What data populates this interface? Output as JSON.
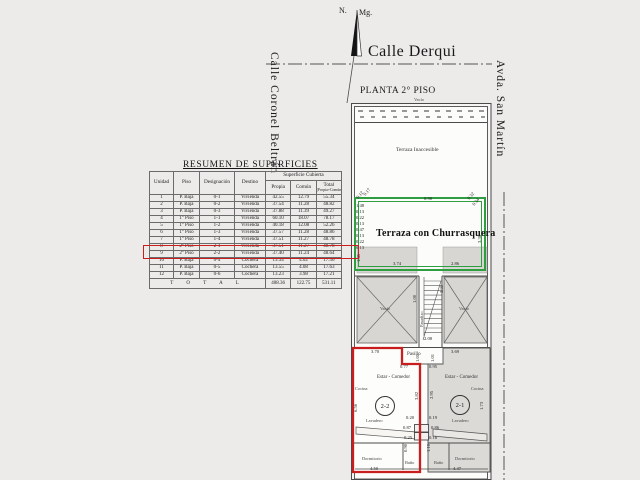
{
  "compass": {
    "north": "N.",
    "magnetic": "Mg."
  },
  "streets": {
    "top": "Calle Derqui",
    "left": "Calle Coronel Beltrán",
    "right": "Avda. San Martín"
  },
  "plan": {
    "title": "PLANTA 2° PISO",
    "band_label": "Vacío",
    "terraza_inaccesible": "Terraza Inaccesible",
    "terraza_churrasquera": "Terraza con Churrasquera",
    "vacio_left": "Vacío",
    "vacio_right": "Vacío",
    "pasadizo": "Pasadizo",
    "pasillo": "Pasillo",
    "units": {
      "left": {
        "badge": "2-2",
        "estar": "Estar - Comedor",
        "cocina": "Cocina",
        "lavadero": "Lavadero",
        "dormitorio": "Dormitorio",
        "bano": "Baño"
      },
      "right": {
        "badge": "2-1",
        "estar": "Estar - Comedor",
        "cocina": "Cocina",
        "lavadero": "Lavadero",
        "dormitorio": "Dormitorio",
        "bano": "Baño"
      }
    },
    "dims": [
      {
        "t": "0.90",
        "x": 424,
        "y": 197,
        "r": 0
      },
      {
        "t": "0.12",
        "x": 356,
        "y": 197,
        "r": -50
      },
      {
        "t": "0.17",
        "x": 363,
        "y": 194,
        "r": -50
      },
      {
        "t": "1.48",
        "x": 356,
        "y": 204,
        "r": 0
      },
      {
        "t": "0.13",
        "x": 356,
        "y": 210,
        "r": 0
      },
      {
        "t": "0.22",
        "x": 356,
        "y": 216,
        "r": 0
      },
      {
        "t": "0.13",
        "x": 356,
        "y": 222,
        "r": 0
      },
      {
        "t": "0.47",
        "x": 356,
        "y": 228,
        "r": 0
      },
      {
        "t": "0.13",
        "x": 356,
        "y": 234,
        "r": 0
      },
      {
        "t": "0.22",
        "x": 356,
        "y": 240,
        "r": 0
      },
      {
        "t": "0.13",
        "x": 356,
        "y": 246,
        "r": 0
      },
      {
        "t": "1.45",
        "x": 357,
        "y": 262,
        "r": -90
      },
      {
        "t": "0.32",
        "x": 467,
        "y": 198,
        "r": -50
      },
      {
        "t": "0.34",
        "x": 472,
        "y": 204,
        "r": -50
      },
      {
        "t": "3.38",
        "x": 478,
        "y": 243,
        "r": -90
      },
      {
        "t": "3.74",
        "x": 393,
        "y": 262,
        "r": 0
      },
      {
        "t": "2.86",
        "x": 451,
        "y": 262,
        "r": 0
      },
      {
        "t": "1.00",
        "x": 413,
        "y": 303,
        "r": -90
      },
      {
        "t": "3.31",
        "x": 440,
        "y": 293,
        "r": -90
      },
      {
        "t": "2.08",
        "x": 424,
        "y": 337,
        "r": 0
      },
      {
        "t": "3.70",
        "x": 371,
        "y": 350,
        "r": 0
      },
      {
        "t": "1.01",
        "x": 416,
        "y": 362,
        "r": -90
      },
      {
        "t": "0.77",
        "x": 400,
        "y": 365,
        "r": 0
      },
      {
        "t": "0.95",
        "x": 429,
        "y": 365,
        "r": 0
      },
      {
        "t": "3.69",
        "x": 451,
        "y": 350,
        "r": 0
      },
      {
        "t": "1.01",
        "x": 431,
        "y": 362,
        "r": -90
      },
      {
        "t": "3.82",
        "x": 415,
        "y": 400,
        "r": -90
      },
      {
        "t": "6.56",
        "x": 354,
        "y": 412,
        "r": -90
      },
      {
        "t": "2.95",
        "x": 430,
        "y": 399,
        "r": -90
      },
      {
        "t": "1.73",
        "x": 480,
        "y": 410,
        "r": -90
      },
      {
        "t": "0.20",
        "x": 406,
        "y": 416,
        "r": 0
      },
      {
        "t": "0.87",
        "x": 403,
        "y": 426,
        "r": 0
      },
      {
        "t": "0.25",
        "x": 404,
        "y": 436,
        "r": 0
      },
      {
        "t": "0.19",
        "x": 429,
        "y": 416,
        "r": 0
      },
      {
        "t": "0.86",
        "x": 431,
        "y": 426,
        "r": 0
      },
      {
        "t": "0.16",
        "x": 429,
        "y": 436,
        "r": 0
      },
      {
        "t": "0.90",
        "x": 404,
        "y": 452,
        "r": -90
      },
      {
        "t": "1.10",
        "x": 427,
        "y": 452,
        "r": -90
      },
      {
        "t": "4.50",
        "x": 370,
        "y": 467,
        "r": 0
      },
      {
        "t": "4.47",
        "x": 453,
        "y": 467,
        "r": 0
      }
    ]
  },
  "table": {
    "title": "RESUMEN DE SUPERFICIES",
    "headers": {
      "unidad": "Unidad",
      "piso": "Piso",
      "designacion": "Designación",
      "destino": "Destino",
      "superficie": "Superficie Cubierta",
      "propia": "Propia",
      "comun": "Común",
      "total": "Total",
      "total_sub": "(Propia+Común)"
    },
    "rows": [
      {
        "n": "1",
        "piso": "P. Baja",
        "des": "0-1",
        "dest": "Vivienda",
        "propia": "42.55",
        "comun": "12.79",
        "total": "55.34"
      },
      {
        "n": "2",
        "piso": "P. Baja",
        "des": "0-2",
        "dest": "Vivienda",
        "propia": "37.54",
        "comun": "11.28",
        "total": "48.82"
      },
      {
        "n": "3",
        "piso": "P. Baja",
        "des": "0-3",
        "dest": "Vivienda",
        "propia": "37.88",
        "comun": "11.39",
        "total": "49.27"
      },
      {
        "n": "4",
        "piso": "1° Piso",
        "des": "1-1",
        "dest": "Vivienda",
        "propia": "60.10",
        "comun": "18.07",
        "total": "78.17"
      },
      {
        "n": "5",
        "piso": "1° Piso",
        "des": "1-2",
        "dest": "Vivienda",
        "propia": "40.18",
        "comun": "12.08",
        "total": "52.26"
      },
      {
        "n": "6",
        "piso": "1° Piso",
        "des": "1-3",
        "dest": "Vivienda",
        "propia": "37.57",
        "comun": "11.28",
        "total": "48.86"
      },
      {
        "n": "7",
        "piso": "1° Piso",
        "des": "1-4",
        "dest": "Vivienda",
        "propia": "37.51",
        "comun": "11.27",
        "total": "48.78"
      },
      {
        "n": "8",
        "piso": "2° Piso",
        "des": "2-1",
        "dest": "Vivienda",
        "propia": "37.51",
        "comun": "11.27",
        "total": "48.78"
      },
      {
        "n": "9",
        "piso": "2° Piso",
        "des": "2-2",
        "dest": "Vivienda",
        "propia": "37.40",
        "comun": "11.24",
        "total": "48.64",
        "highlight": true
      },
      {
        "n": "10",
        "piso": "P. Baja",
        "des": "0-4",
        "dest": "Cochera",
        "propia": "13.34",
        "comun": "4.02",
        "total": "17.36"
      },
      {
        "n": "11",
        "piso": "P. Baja",
        "des": "0-5",
        "dest": "Cochera",
        "propia": "13.55",
        "comun": "4.08",
        "total": "17.63"
      },
      {
        "n": "12",
        "piso": "P. Baja",
        "des": "0-6",
        "dest": "Cochera",
        "propia": "13.23",
        "comun": "3.98",
        "total": "17.21"
      }
    ],
    "total": {
      "label": "T O T A L",
      "propia": "408.36",
      "comun": "122.75",
      "total": "531.11"
    }
  },
  "colors": {
    "highlight_red": "#c81e1e",
    "terrace_green": "#2f9e41"
  }
}
